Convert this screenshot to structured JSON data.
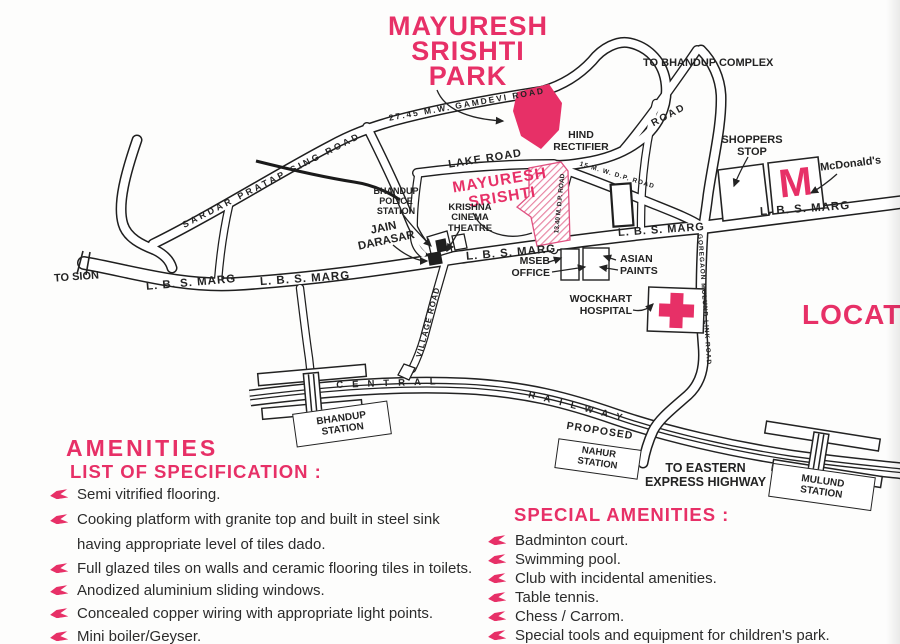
{
  "colors": {
    "pink": "#e73067",
    "ink": "#232323",
    "hatch_pink": "#e886a4"
  },
  "title": "MAYURESH\nSRISHTI\nPARK",
  "location_heading": "LOCATION",
  "map": {
    "to_bhandup_complex": "TO BHANDUP COMPLEX",
    "road_ne": "ROAD",
    "shoppers_stop": "SHOPPERS\nSTOP",
    "mcdonalds": "McDonald's",
    "mcdonalds_m": "M",
    "lbs_marg_right": "L. B. S. MARG",
    "hind_rectifier": "HIND\nRECTIFIER",
    "lake_road": "LAKE ROAD",
    "site_label": "MAYURESH\nSRISHTI",
    "krishna_cinema": "KRISHNA\nCINEMA\nTHEATRE",
    "bhandup_police": "BHANDUP\nPOLICE\nSTATION",
    "jain_darasar": "JAIN\nDARASAR",
    "lbs_marg_center": "L. B. S. MARG",
    "lbs_marg_mid": "L. B. S. MARG",
    "mseb_office": "MSEB\nOFFICE",
    "asian_paints": "ASIAN\nPAINTS",
    "wockhart_hospital": "WOCKHART\nHOSPITAL",
    "to_sion": "TO SION",
    "lbs_marg_left1": "L. B. S. MARG",
    "lbs_marg_left2": "L. B. S. MARG",
    "sardar_road": "SARDAR PRATAP SING ROAD",
    "gamdevi_road": "27.45 M.W. GAMDEVI ROAD",
    "dp_road": "15 M. W. D.P. ROAD",
    "mp_road": "13.40 M. D.P. ROAD",
    "goregaon_link_road": "GOREGAON MULUND LINK ROAD",
    "village_road": "VILLAGE ROAD",
    "central": "CENTRAL",
    "railway": "RAILWAY",
    "bhandup_station": "BHANDUP\nSTATION",
    "proposed": "PROPOSED",
    "nahur_station": "NAHUR\nSTATION",
    "to_eastern": "TO EASTERN\nEXPRESS HIGHWAY",
    "mulund_station": "MULUND\nSTATION"
  },
  "amenities": {
    "heading": "AMENITIES",
    "subheading": "LIST OF SPECIFICATION :",
    "items": [
      "Semi vitrified flooring.",
      "Cooking platform with granite top and built in steel sink",
      "having appropriate level of tiles dado.",
      "Full glazed tiles on walls and ceramic flooring tiles in toilets.",
      "Anodized aluminium sliding windows.",
      "Concealed copper wiring with appropriate light points.",
      "Mini boiler/Geyser."
    ]
  },
  "special_amenities": {
    "heading": "SPECIAL AMENITIES :",
    "items": [
      "Badminton court.",
      "Swimming pool.",
      "Club with incidental amenities.",
      "Table tennis.",
      "Chess / Carrom.",
      "Special tools and equipment for children's park."
    ]
  }
}
